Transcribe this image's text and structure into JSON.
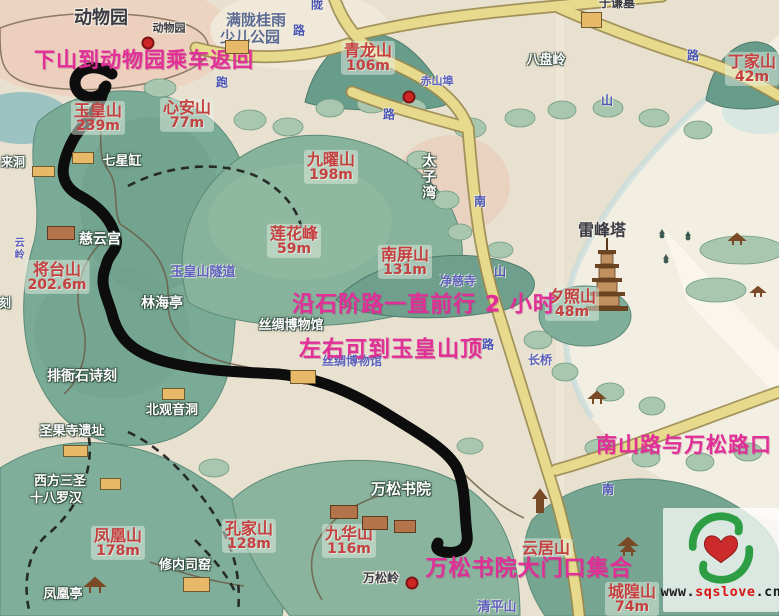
{
  "colors": {
    "annotation": "#e02f97",
    "peak_label": "#c54040",
    "blue_label": "#5d60bd",
    "route": "#0d0d0d",
    "road": "#e7da8d",
    "hill": "#7fae9a",
    "lake": "#f3eee2",
    "paper": "#e9e1cf",
    "logo_heart": "#cc2b2b",
    "logo_hands": "#2e9e44"
  },
  "annotations": [
    {
      "text": "下山到动物园乘车返回",
      "x": 144,
      "y": 61,
      "size": 21
    },
    {
      "text": "沿石阶路一直前行 2 小时",
      "x": 424,
      "y": 306,
      "size": 22
    },
    {
      "text": "左右可到玉皇山顶",
      "x": 391,
      "y": 351,
      "size": 22
    },
    {
      "text": "南山路与万松路口",
      "x": 684,
      "y": 446,
      "size": 21
    },
    {
      "text": "万松书院大门口集合",
      "x": 529,
      "y": 570,
      "size": 22
    }
  ],
  "peaks": [
    {
      "name": "玉皇山",
      "elevation": "239m",
      "x": 98,
      "y": 118
    },
    {
      "name": "心安山",
      "elevation": "77m",
      "x": 187,
      "y": 115
    },
    {
      "name": "青龙山",
      "elevation": "106m",
      "x": 368,
      "y": 58
    },
    {
      "name": "丁家山",
      "elevation": "42m",
      "x": 752,
      "y": 69
    },
    {
      "name": "九曜山",
      "elevation": "198m",
      "x": 331,
      "y": 167
    },
    {
      "name": "莲花峰",
      "elevation": "59m",
      "x": 294,
      "y": 241
    },
    {
      "name": "南屏山",
      "elevation": "131m",
      "x": 405,
      "y": 262
    },
    {
      "name": "夕照山",
      "elevation": "48m",
      "x": 572,
      "y": 304
    },
    {
      "name": "将台山",
      "elevation": "202.6m",
      "x": 57,
      "y": 277
    },
    {
      "name": "凤凰山",
      "elevation": "178m",
      "x": 118,
      "y": 543
    },
    {
      "name": "孔家山",
      "elevation": "128m",
      "x": 249,
      "y": 536
    },
    {
      "name": "九华山",
      "elevation": "116m",
      "x": 349,
      "y": 541
    },
    {
      "name": "云居山",
      "elevation": "",
      "x": 546,
      "y": 548
    },
    {
      "name": "城隍山",
      "elevation": "74m",
      "x": 632,
      "y": 599
    }
  ],
  "places": [
    {
      "text": "动物园",
      "x": 101,
      "y": 19,
      "style": "dark",
      "size": 18
    },
    {
      "text": "动物园",
      "x": 169,
      "y": 28,
      "style": "dark",
      "size": 11
    },
    {
      "text": "满陇桂雨",
      "x": 256,
      "y": 21,
      "style": "slate",
      "size": 15
    },
    {
      "text": "少儿公园",
      "x": 250,
      "y": 38,
      "style": "slate",
      "size": 15
    },
    {
      "text": "于谦墓",
      "x": 617,
      "y": 3,
      "style": "dark",
      "size": 12
    },
    {
      "text": "雷峰塔",
      "x": 602,
      "y": 231,
      "style": "dark",
      "size": 16
    },
    {
      "text": "万松岭",
      "x": 381,
      "y": 578,
      "style": "dark",
      "size": 12
    },
    {
      "text": "八盘岭",
      "x": 546,
      "y": 61,
      "style": "white",
      "size": 13
    },
    {
      "text": "七星缸",
      "x": 122,
      "y": 162,
      "style": "white",
      "size": 13
    },
    {
      "text": "慈云宫",
      "x": 100,
      "y": 240,
      "style": "white",
      "size": 14
    },
    {
      "text": "林海亭",
      "x": 162,
      "y": 304,
      "style": "white",
      "size": 14
    },
    {
      "text": "排衙石诗刻",
      "x": 82,
      "y": 377,
      "style": "white",
      "size": 14
    },
    {
      "text": "北观音洞",
      "x": 172,
      "y": 411,
      "style": "white",
      "size": 13
    },
    {
      "text": "圣果寺遗址",
      "x": 72,
      "y": 432,
      "style": "white",
      "size": 13
    },
    {
      "text": "西方三圣",
      "x": 60,
      "y": 482,
      "style": "white",
      "size": 13
    },
    {
      "text": "十八罗汉",
      "x": 56,
      "y": 499,
      "style": "white",
      "size": 13
    },
    {
      "text": "凤凰亭",
      "x": 63,
      "y": 595,
      "style": "white",
      "size": 13
    },
    {
      "text": "修内司窑",
      "x": 185,
      "y": 566,
      "style": "white",
      "size": 13
    },
    {
      "text": "万松书院",
      "x": 401,
      "y": 490,
      "style": "white",
      "size": 15
    },
    {
      "text": "丝绸博物馆",
      "x": 291,
      "y": 326,
      "style": "white",
      "size": 13
    },
    {
      "text": "来洞",
      "x": 13,
      "y": 162,
      "style": "white",
      "size": 12
    },
    {
      "text": "刻",
      "x": 5,
      "y": 303,
      "style": "white",
      "size": 12
    },
    {
      "text": "太子湾",
      "x": 428,
      "y": 177,
      "style": "white",
      "size": 14,
      "vertical": true
    },
    {
      "text": "玉皇山隧道",
      "x": 203,
      "y": 273,
      "style": "blue",
      "size": 13
    },
    {
      "text": "赤山埠",
      "x": 437,
      "y": 81,
      "style": "blue",
      "size": 11
    },
    {
      "text": "丝绸博物馆",
      "x": 352,
      "y": 361,
      "style": "blue",
      "size": 12
    },
    {
      "text": "长桥",
      "x": 540,
      "y": 360,
      "style": "blue",
      "size": 12
    },
    {
      "text": "净慈寺",
      "x": 458,
      "y": 281,
      "style": "blue",
      "size": 12
    },
    {
      "text": "清平山",
      "x": 497,
      "y": 608,
      "style": "blue",
      "size": 13
    },
    {
      "text": "云岭",
      "x": 17,
      "y": 249,
      "style": "blue",
      "size": 10,
      "vertical": true
    }
  ],
  "road_labels": [
    {
      "text": "陇",
      "x": 317,
      "y": 4
    },
    {
      "text": "路",
      "x": 299,
      "y": 30
    },
    {
      "text": "跑",
      "x": 222,
      "y": 82
    },
    {
      "text": "路",
      "x": 389,
      "y": 114
    },
    {
      "text": "路",
      "x": 693,
      "y": 55
    },
    {
      "text": "山",
      "x": 607,
      "y": 100
    },
    {
      "text": "南",
      "x": 480,
      "y": 201
    },
    {
      "text": "山",
      "x": 500,
      "y": 271
    },
    {
      "text": "路",
      "x": 488,
      "y": 344
    },
    {
      "text": "南",
      "x": 608,
      "y": 489
    }
  ],
  "markers": {
    "red_dots": [
      {
        "x": 148,
        "y": 43
      },
      {
        "x": 409,
        "y": 97
      },
      {
        "x": 305,
        "y": 378
      },
      {
        "x": 412,
        "y": 583
      }
    ],
    "buildings": [
      {
        "x": 72,
        "y": 152,
        "w": 20,
        "h": 10,
        "type": "tan"
      },
      {
        "x": 32,
        "y": 166,
        "w": 21,
        "h": 9,
        "type": "tan"
      },
      {
        "x": 225,
        "y": 40,
        "w": 22,
        "h": 12,
        "type": "tan"
      },
      {
        "x": 581,
        "y": 12,
        "w": 19,
        "h": 14,
        "type": "tan"
      },
      {
        "x": 162,
        "y": 388,
        "w": 21,
        "h": 10,
        "type": "tan"
      },
      {
        "x": 63,
        "y": 445,
        "w": 23,
        "h": 10,
        "type": "tan"
      },
      {
        "x": 100,
        "y": 478,
        "w": 19,
        "h": 10,
        "type": "tan"
      },
      {
        "x": 183,
        "y": 577,
        "w": 25,
        "h": 13,
        "type": "tan"
      },
      {
        "x": 290,
        "y": 370,
        "w": 24,
        "h": 12,
        "type": "tan"
      },
      {
        "x": 47,
        "y": 226,
        "w": 26,
        "h": 12,
        "type": "brown"
      },
      {
        "x": 330,
        "y": 505,
        "w": 26,
        "h": 12,
        "type": "brown"
      },
      {
        "x": 362,
        "y": 516,
        "w": 24,
        "h": 12,
        "type": "brown"
      },
      {
        "x": 394,
        "y": 520,
        "w": 20,
        "h": 11,
        "type": "brown"
      }
    ]
  },
  "logo": {
    "url_www": "www.",
    "url_name": "sqslove",
    "url_tld": ".cn"
  }
}
